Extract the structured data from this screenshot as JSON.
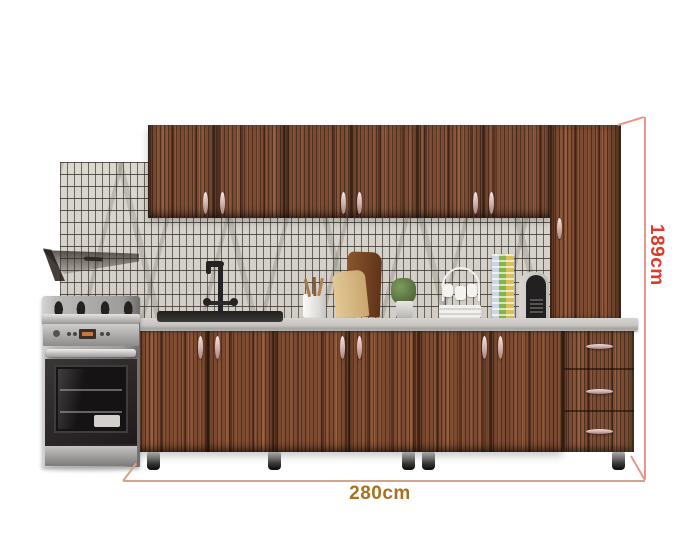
{
  "dimensions": {
    "width": {
      "label": "280cm",
      "color": "#a9701f"
    },
    "height": {
      "label": "189cm",
      "color": "#e03a2c"
    },
    "line_color": "#e8958a"
  },
  "product": {
    "name": "kitchen-cabinet-set",
    "wall_cabinet_doors": 6,
    "tall_cabinet_doors": 1,
    "base_cabinet_doors": 6,
    "drawers": 3,
    "finish": {
      "wood": "#7b4b33",
      "countertop": "#c8c6c2",
      "tile": "#d8d4cc",
      "grout": "#38342f"
    },
    "appliances": [
      "gas-range-oven",
      "range-hood",
      "coffee-machine"
    ],
    "accessories": [
      "black-sink-faucet",
      "utensil-holder",
      "cutting-boards",
      "potted-plant",
      "mug-rack",
      "capsule-rack"
    ]
  }
}
